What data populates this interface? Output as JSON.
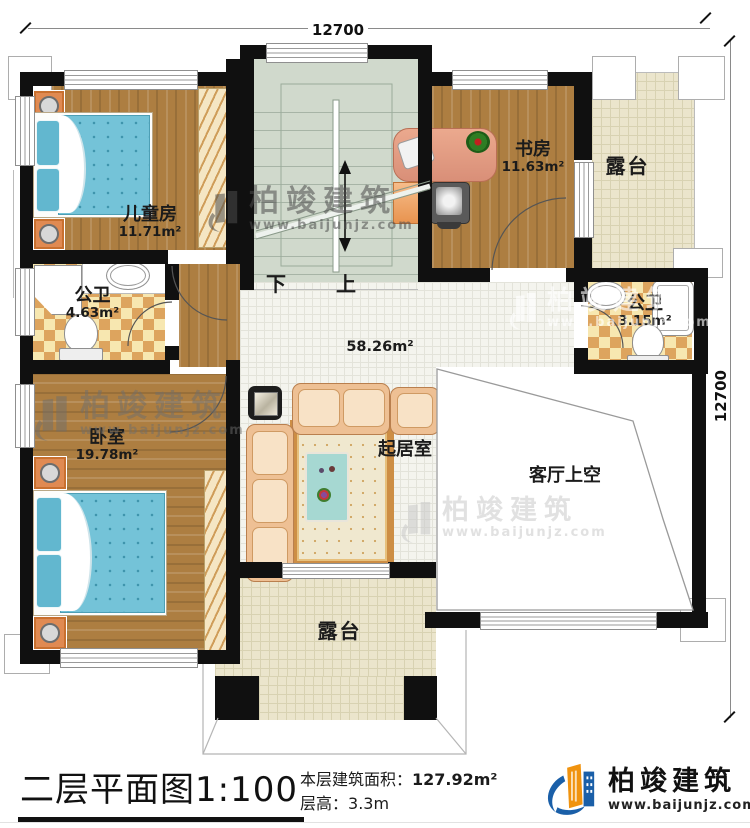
{
  "dimensions": {
    "top": "12700",
    "right": "12700"
  },
  "stairs": {
    "down": "下",
    "up": "上"
  },
  "rooms": {
    "children": {
      "name": "儿童房",
      "area": "11.71m²"
    },
    "study": {
      "name": "书房",
      "area": "11.63m²"
    },
    "terrace_top": {
      "name": "露台"
    },
    "bath_left": {
      "name": "公卫",
      "area": "4.63m²"
    },
    "bath_right": {
      "name": "公卫",
      "area": "3.15m²"
    },
    "bedroom": {
      "name": "卧室",
      "area": "19.78m²"
    },
    "hall": {
      "name": "起居室",
      "area": "58.26m²"
    },
    "void": {
      "name": "客厅上空"
    },
    "terrace_bottom": {
      "name": "露台"
    }
  },
  "caption": {
    "title": "二层平面图",
    "scale": "1:100",
    "area_label": "本层建筑面积：",
    "area_value": "127.92m²",
    "height_label": "层高：",
    "height_value": "3.3m"
  },
  "brand": {
    "name": "柏竣建筑",
    "url": "www.baijunjz.com"
  },
  "watermark": {
    "name": "柏竣建筑",
    "url": "www.baijunjz.com"
  },
  "colors": {
    "wall": "#101010",
    "wood": "#ad7e41",
    "stair": "#d0d9cc",
    "terrace": "#ebe5cc",
    "hall_tile": "#f4f4ee",
    "checker_light": "#f7e7b0",
    "checker_dark": "#dda45e",
    "bed_blue": "#74c3d8",
    "sofa_tan": "#eec094",
    "logo_blue": "#1a5fa8",
    "logo_orange": "#f0930f"
  }
}
